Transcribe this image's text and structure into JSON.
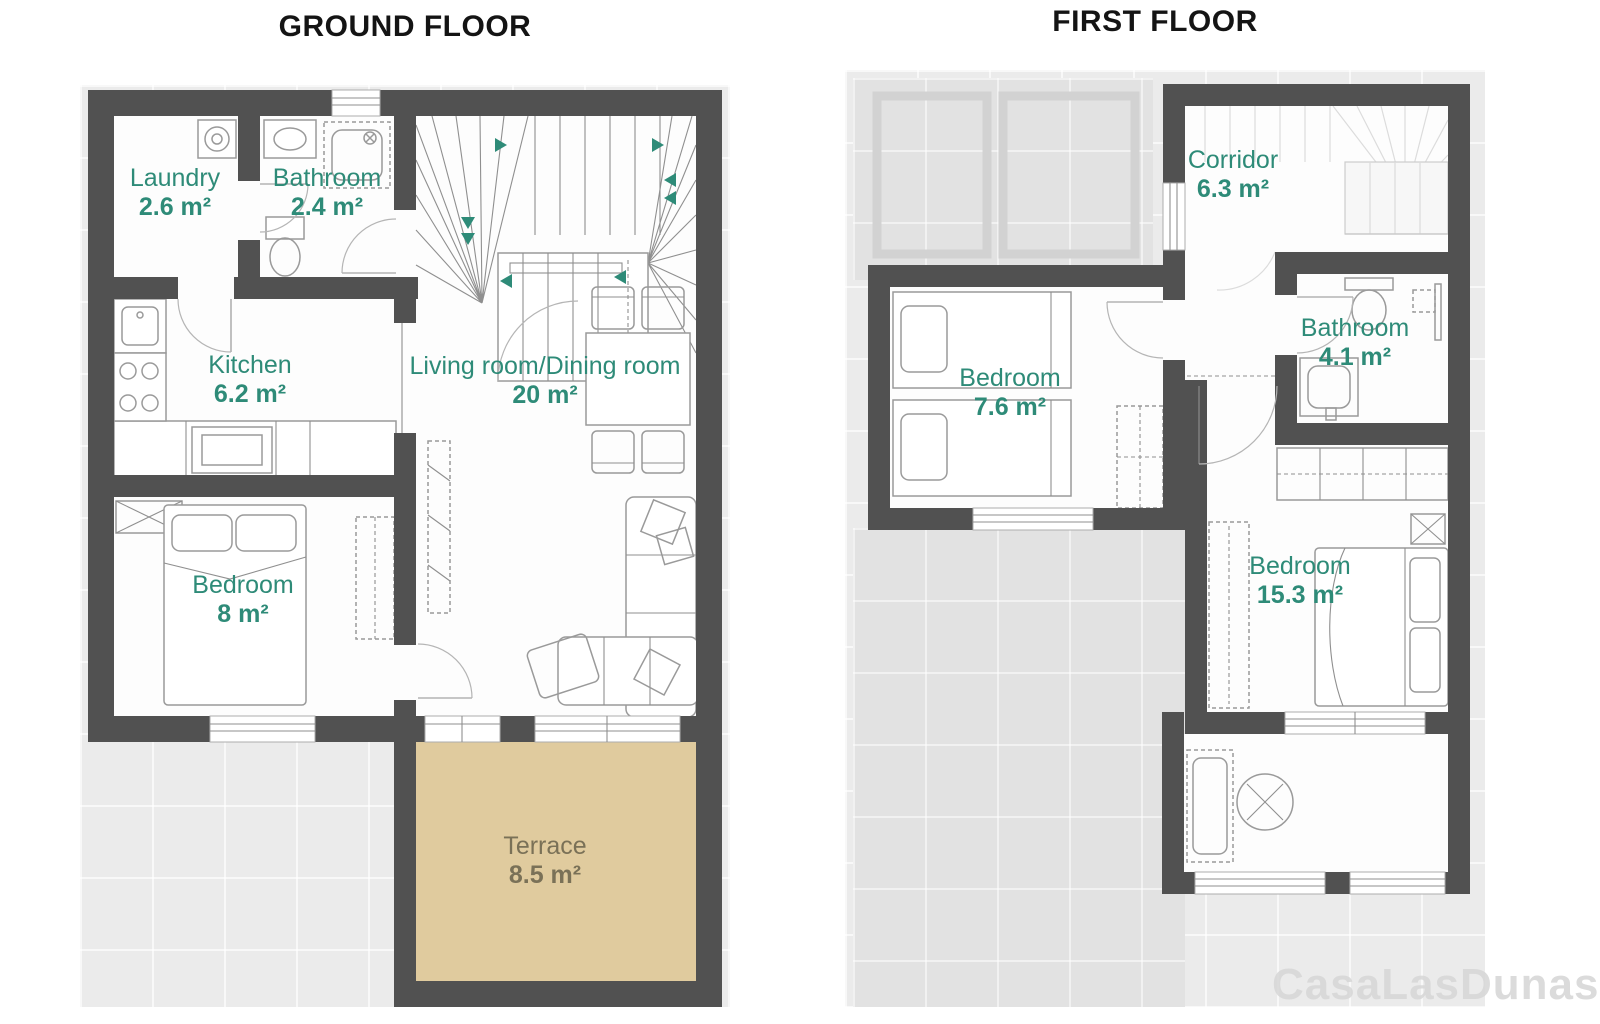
{
  "ground": {
    "title": "GROUND FLOOR",
    "rooms": [
      {
        "name": "Laundry",
        "area": "2.6 m²"
      },
      {
        "name": "Bathroom",
        "area": "2.4 m²"
      },
      {
        "name": "Kitchen",
        "area": "6.2 m²"
      },
      {
        "name": "Living room/Dining room",
        "area": "20 m²"
      },
      {
        "name": "Bedroom",
        "area": "8 m²"
      },
      {
        "name": "Terrace",
        "area": "8.5 m²"
      }
    ]
  },
  "first": {
    "title": "FIRST FLOOR",
    "rooms": [
      {
        "name": "Corridor",
        "area": "6.3 m²"
      },
      {
        "name": "Bedroom",
        "area": "7.6 m²"
      },
      {
        "name": "Bathroom",
        "area": "4.1 m²"
      },
      {
        "name": "Bedroom",
        "area": "15.3 m²"
      }
    ]
  },
  "watermark": "CasaLasDunas",
  "colors": {
    "wall": "#515151",
    "room_label": "#2e8b78",
    "terrace_fill": "#e0cb9e",
    "terrace_label": "#7a7157",
    "floor_background": "#ebebeb",
    "roof_background": "#e2e2e2",
    "stair_arrow": "#2e8b78"
  }
}
